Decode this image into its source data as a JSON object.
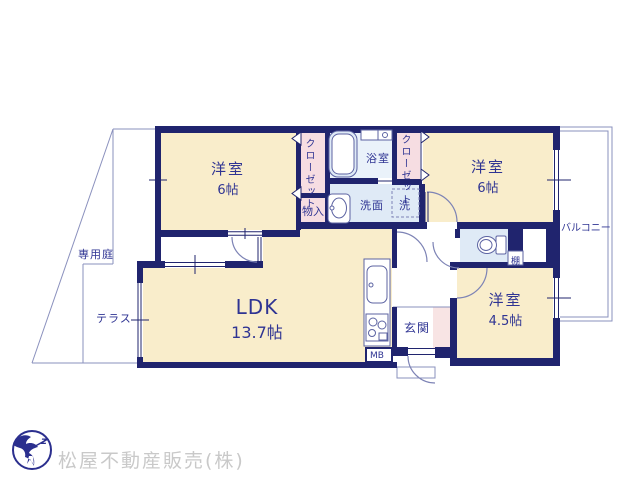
{
  "plan": {
    "bedroom_left": {
      "name": "洋室",
      "size": "6帖"
    },
    "bedroom_right": {
      "name": "洋室",
      "size": "6帖"
    },
    "bedroom_small": {
      "name": "洋室",
      "size": "4.5帖"
    },
    "ldk": {
      "name": "LDK",
      "size": "13.7帖"
    },
    "bathroom": "浴室",
    "washroom": "洗面",
    "washing_machine": "洗",
    "closet_left": "クローゼット",
    "closet_right": "クローゼット",
    "storage": "物入",
    "shelf": "棚",
    "entrance": "玄関",
    "meter_box": "MB",
    "balcony": "バルコニー",
    "private_garden": "専用庭",
    "terrace": "テラス"
  },
  "footer": {
    "company": "松屋不動産販売(株)",
    "logo_mark": "z"
  },
  "colors": {
    "wall": "#20246e",
    "boundary_line": "#8a90bd",
    "door_arc": "#7d83b5",
    "room_cream": "#f9edcb",
    "closet_pink": "#f6dde2",
    "wet_blue": "#dfeaf6",
    "bath_blue": "#eaf2fa",
    "genkan_pink": "#f8e4e4",
    "label_text": "#2f3493",
    "company_gray": "#c9c9c9",
    "logo_navy": "#2b2f8e"
  }
}
